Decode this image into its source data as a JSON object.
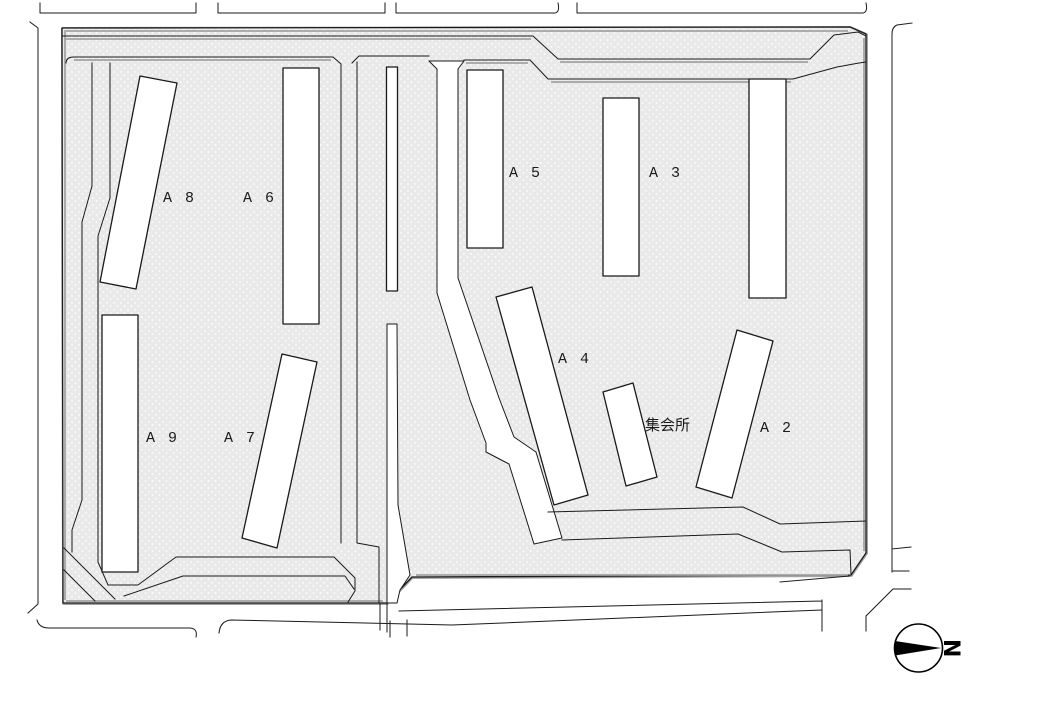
{
  "canvas": {
    "width": 1040,
    "height": 720
  },
  "colors": {
    "background": "#ffffff",
    "site_fill": "#e9e9e9",
    "line": "#1a1a1a",
    "shadow": "#a3a3a3",
    "building_fill": "#ffffff"
  },
  "labels": {
    "a8": "A 8",
    "a6": "A 6",
    "a5": "A 5",
    "a3": "A 3",
    "a4": "A 4",
    "a2": "A 2",
    "a9": "A 9",
    "a7": "A 7",
    "meeting_hall": "集会所"
  },
  "compass": {
    "north_letter": "N"
  }
}
